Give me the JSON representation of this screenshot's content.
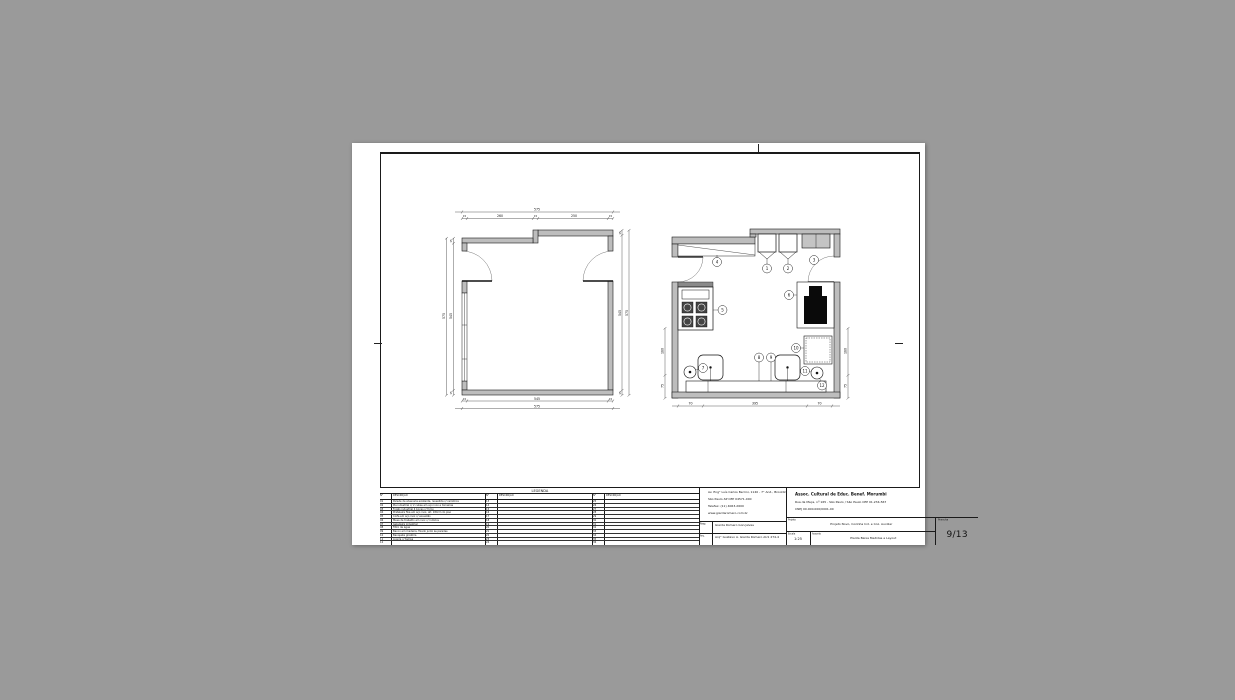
{
  "colors": {
    "background": "#9a9a9a",
    "paper": "#ffffff",
    "wall_fill": "#bdbdbd",
    "line": "#1a1a1a"
  },
  "sheet": {
    "legend": {
      "title": "LEGENDA",
      "col_no": "N°",
      "col_desc": "DESCRIÇÃO",
      "groups": [
        {
          "rows": [
            {
              "no": "01",
              "desc": "Parede de alvenaria existente, revestida c/ cerâmica"
            },
            {
              "no": "02",
              "desc": "Pia industrial c/ 2 cubas em aço inox e torneiras"
            },
            {
              "no": "03",
              "desc": "Fogão industrial 4 bocas c/ forno"
            },
            {
              "no": "04",
              "desc": "Prateleira fixa em aço inox, alt. 180cm do piso"
            },
            {
              "no": "05",
              "desc": "Coifa em aço inox c/ exaustão"
            },
            {
              "no": "06",
              "desc": "Mesa de trabalho em inox c/ rodízios"
            },
            {
              "no": "07",
              "desc": "Geladeira industrial"
            },
            {
              "no": "08",
              "desc": "Filtro de água"
            },
            {
              "no": "09",
              "desc": "Banco em madeira, fixado junto às paredes"
            },
            {
              "no": "10",
              "desc": "Banqueta giratória"
            },
            {
              "no": "11",
              "desc": "Lixeira c/ tampa"
            },
            {
              "no": "12",
              "desc": ""
            }
          ]
        },
        {
          "rows": [
            {
              "no": "13",
              "desc": ""
            },
            {
              "no": "14",
              "desc": ""
            },
            {
              "no": "15",
              "desc": ""
            },
            {
              "no": "16",
              "desc": ""
            },
            {
              "no": "17",
              "desc": ""
            },
            {
              "no": "18",
              "desc": ""
            },
            {
              "no": "19",
              "desc": ""
            },
            {
              "no": "20",
              "desc": ""
            },
            {
              "no": "21",
              "desc": ""
            },
            {
              "no": "22",
              "desc": ""
            },
            {
              "no": "23",
              "desc": ""
            },
            {
              "no": "24",
              "desc": ""
            }
          ]
        },
        {
          "rows": [
            {
              "no": "25",
              "desc": ""
            },
            {
              "no": "26",
              "desc": ""
            },
            {
              "no": "27",
              "desc": ""
            },
            {
              "no": "28",
              "desc": ""
            },
            {
              "no": "29",
              "desc": ""
            },
            {
              "no": "30",
              "desc": ""
            },
            {
              "no": "31",
              "desc": ""
            },
            {
              "no": "32",
              "desc": ""
            },
            {
              "no": "33",
              "desc": ""
            },
            {
              "no": "34",
              "desc": ""
            },
            {
              "no": "35",
              "desc": ""
            },
            {
              "no": "36",
              "desc": ""
            }
          ]
        }
      ]
    },
    "office": {
      "address_lines": [
        "Av. Eng° Luís Carlos Berrini, 1140 - 7° And., Brooklin",
        "São Paulo-SP CEP 04571-000",
        "Telefax: (11) 4063-2600",
        "www.giardaromero.com.br"
      ],
      "resp_label": "Resp.",
      "resp_value": "Giarda Romero Gonçalves",
      "reg_label": "Arq.",
      "reg_value": "Arq° Gustavo A. Giarda Romero AU1 274-4"
    },
    "client": {
      "name": "Assoc. Cultural de Educ. Benef. Morumbi",
      "address_line1": "Rua da Maça, nº 165 - São Paulo / São Paulo CEP 01.234-567",
      "address_line2": "CNPJ 00.000.000/0001-00"
    },
    "project": {
      "label": "Projeto",
      "value": "Projeto Novo, Cozinha Ind. e Coz. Auxiliar"
    },
    "prancha": {
      "label": "Prancha",
      "value": "9/13"
    },
    "escala": {
      "label": "Escala",
      "value": "1:25"
    },
    "assunto": {
      "label": "Assunto",
      "value": "Planta Baixa Medidas e Layout"
    }
  },
  "plans": {
    "left": {
      "dims": {
        "top_total": "575",
        "ts1": "15",
        "ts2": "260",
        "ts3": "15",
        "ts4": "250",
        "ts5": "15",
        "bi1": "15",
        "bi2": "545",
        "bi3": "15",
        "bottom_total": "575",
        "li_t": "15",
        "li_m": "545",
        "li_b": "15",
        "left_total": "575",
        "ri_t": "15",
        "ri_m": "545",
        "ri_b": "15",
        "right_total": "575"
      }
    },
    "right": {
      "dims": {
        "b1": "70",
        "b2": "395",
        "b3": "70",
        "l1": "180",
        "l2": "75",
        "r1": "180",
        "r2": "75"
      },
      "balloons": [
        {
          "n": "1"
        },
        {
          "n": "2"
        },
        {
          "n": "3"
        },
        {
          "n": "4"
        },
        {
          "n": "5"
        },
        {
          "n": "6"
        },
        {
          "n": "7"
        },
        {
          "n": "8"
        },
        {
          "n": "9"
        },
        {
          "n": "10"
        },
        {
          "n": "11"
        },
        {
          "n": "12"
        }
      ]
    }
  }
}
